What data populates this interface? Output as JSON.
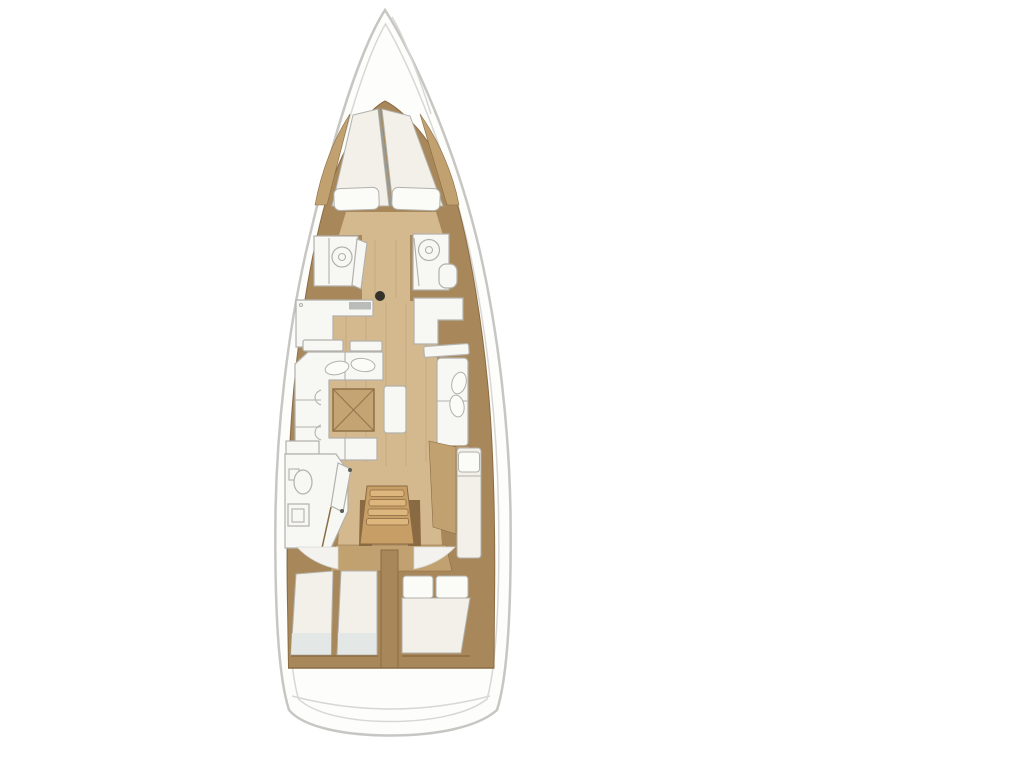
{
  "figure": {
    "type": "yacht-interior-floorplan",
    "description": "Top-view interior layout plan of a sailing yacht, bow pointing up",
    "orientation": "bow-up"
  },
  "colors": {
    "background": "#ffffff",
    "hull_fill": "#fdfdfc",
    "hull_stroke": "#c7c6c3",
    "deck_line": "#d8d7d3",
    "deck_white": "#f3f2ee",
    "wood_dark": "#a8885a",
    "wood_mid": "#c2a171",
    "wood_floor": "#d5b98e",
    "floor_seam": "#b69a6e",
    "fixture_white": "#f7f7f4",
    "fixture_stroke": "#b2b1ab",
    "mattress": "#f2f0e9",
    "mattress_shade": "#e3e7e6",
    "pillow": "#fbfbf8",
    "table_wood": "#c5a473",
    "table_stroke": "#8e7046",
    "stair_wood": "#c79e66",
    "stair_step": "#dcb67d",
    "stair_rail": "#8a6a42",
    "counter_inset": "#b9bcb8",
    "wall_stroke": "#8a6c44",
    "mast": "#35322c"
  },
  "areas": {
    "hull": "Yacht hull, top view",
    "foredeck": "Foredeck",
    "forward_cabin": "Forward V-berth cabin",
    "port_forward_head": "Port forward bathroom with sink",
    "starboard_forward_head": "Starboard forward bathroom with sink and toilet",
    "galley": "Port galley counter with stove",
    "chart_table": "Starboard counter",
    "salon": "Salon with U-shaped sofa, folding table and bench",
    "starboard_settee": "Starboard settee with cushions",
    "port_aft_head": "Port aft bathroom with toilet and sink",
    "companionway": "Companionway stairs",
    "starboard_berth": "Starboard single berth with wardrobe",
    "port_aft_cabin": "Port aft cabin with twin berths",
    "starboard_aft_cabin": "Starboard aft cabin with double berth",
    "mast": "Mast position",
    "stern": "Stern / transom"
  }
}
